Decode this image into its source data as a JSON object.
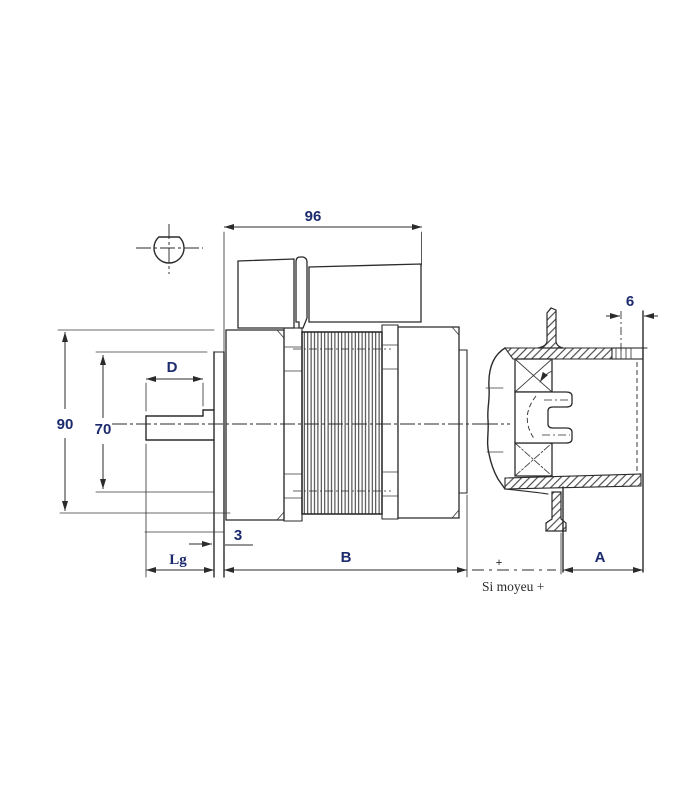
{
  "drawing": {
    "type": "technical-dimension-drawing",
    "labels": {
      "dim_96": "96",
      "dim_d": "D",
      "dim_90": "90",
      "dim_70": "70",
      "dim_3": "3",
      "dim_lg": "Lg",
      "dim_b": "B",
      "dim_6": "6",
      "dim_a": "A",
      "plus_mark": "+",
      "hub_note": "Si moyeu +"
    },
    "colors": {
      "background": "#ffffff",
      "line": "#2b2b2b",
      "dimension_text": "#1c2a6e",
      "note_text": "#2b2b2b"
    }
  }
}
